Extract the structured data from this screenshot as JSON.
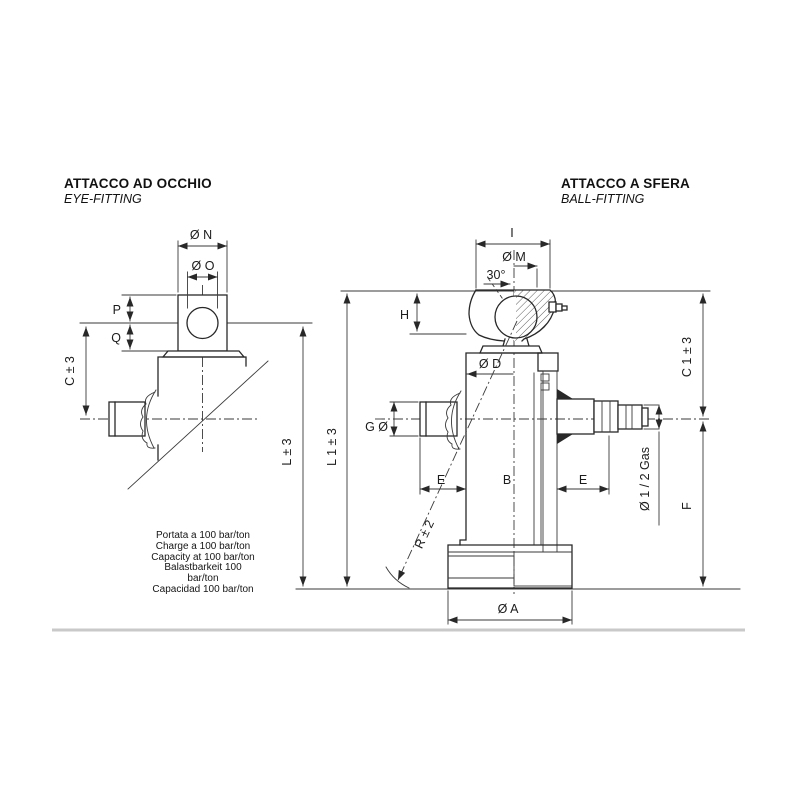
{
  "page": {
    "bg": "#ffffff",
    "border_color": "#c9c9c9"
  },
  "left_view": {
    "title": "ATTACCO AD OCCHIO",
    "subtitle": "EYE-FITTING",
    "labels": {
      "n": "Ø N",
      "o": "Ø O",
      "p": "P",
      "q": "Q",
      "c": "C ± 3",
      "l": "L ± 3"
    }
  },
  "right_view": {
    "title": "ATTACCO A SFERA",
    "subtitle": "BALL-FITTING",
    "labels": {
      "i": "I",
      "m": "Ø M",
      "angle": "30°",
      "h": "H",
      "d": "Ø D",
      "g": "G Ø",
      "e_left": "E",
      "b": "B",
      "e_right": "E",
      "r": "R ± 2",
      "l1": "L 1 ± 3",
      "c1": "C 1 ± 3",
      "gas": "Ø 1 / 2 Gas",
      "f": "F",
      "a": "Ø A"
    }
  },
  "capacity_note": {
    "lines": [
      "Portata a 100 bar/ton",
      "Charge a 100 bar/ton",
      "Capacity at 100 bar/ton",
      "Balastbarkeit 100",
      "bar/ton",
      "Capacidad 100 bar/ton"
    ]
  }
}
